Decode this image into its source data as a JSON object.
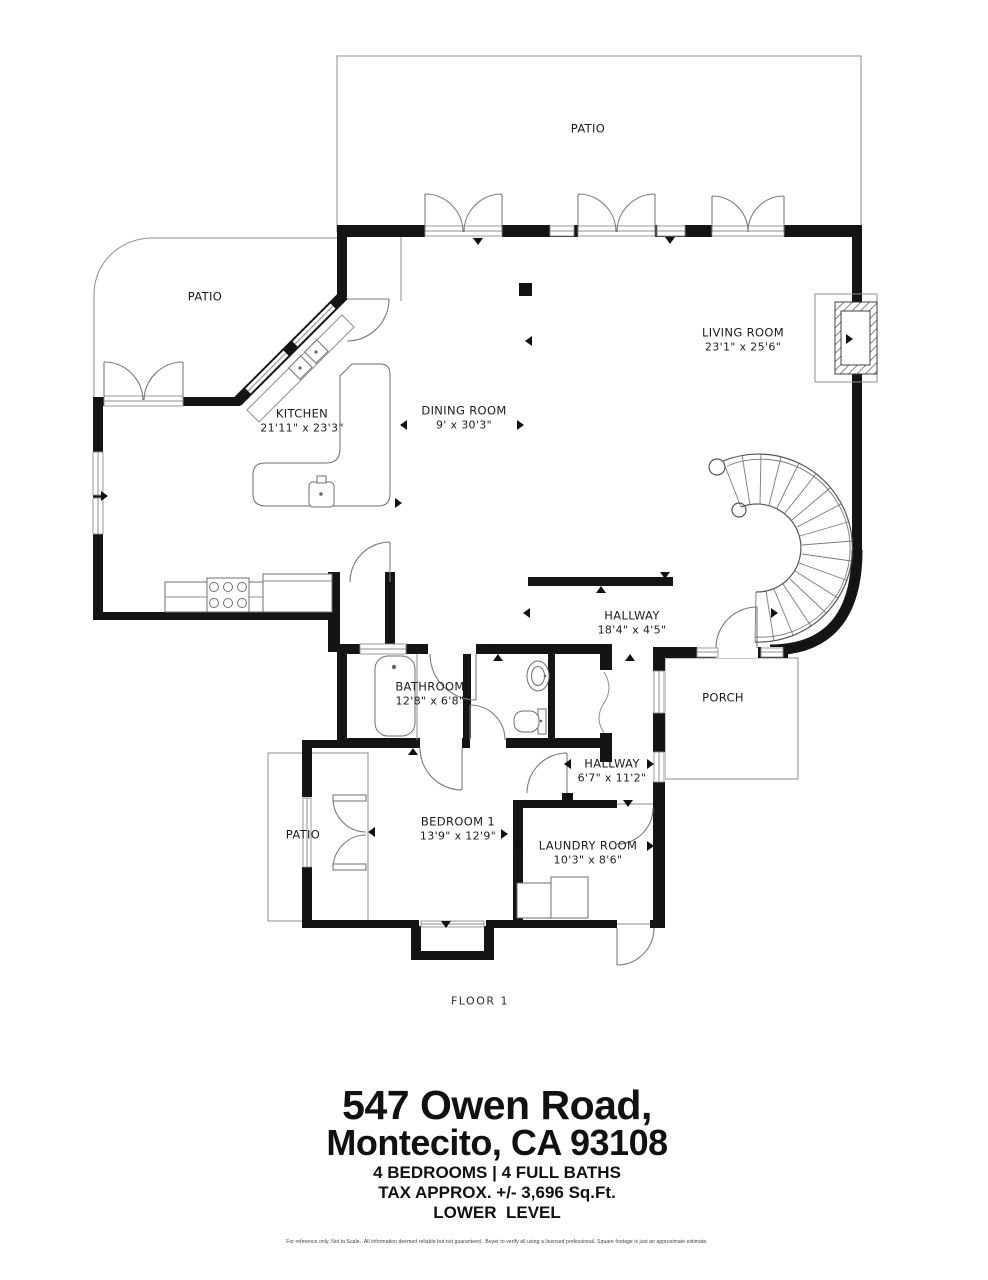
{
  "colors": {
    "walls": "#141414",
    "thin_lines": "#8e8e8e",
    "label_text": "#1c1c1c",
    "background": "#ffffff"
  },
  "plan": {
    "floor_label": "FLOOR 1",
    "areas": [
      {
        "id": "patio-top",
        "name": "PATIO"
      },
      {
        "id": "patio-left",
        "name": "PATIO"
      },
      {
        "id": "porch",
        "name": "PORCH"
      },
      {
        "id": "patio-bottom",
        "name": "PATIO"
      }
    ],
    "rooms": [
      {
        "id": "living-room",
        "name": "LIVING ROOM",
        "dims": "23'1\" x 25'6\""
      },
      {
        "id": "kitchen",
        "name": "KITCHEN",
        "dims": "21'11\" x 23'3\""
      },
      {
        "id": "dining-room",
        "name": "DINING ROOM",
        "dims": "9' x 30'3\""
      },
      {
        "id": "hallway-main",
        "name": "HALLWAY",
        "dims": "18'4\" x 4'5\""
      },
      {
        "id": "bathroom",
        "name": "BATHROOM",
        "dims": "12'8\" x 6'8\""
      },
      {
        "id": "hallway-lower",
        "name": "HALLWAY",
        "dims": "6'7\" x 11'2\""
      },
      {
        "id": "bedroom-1",
        "name": "BEDROOM 1",
        "dims": "13'9\" x 12'9\""
      },
      {
        "id": "laundry-room",
        "name": "LAUNDRY ROOM",
        "dims": "10'3\" x 8'6\""
      }
    ]
  },
  "title_block": {
    "address_line1": "547 Owen Road,",
    "address_line2": "Montecito, CA 93108",
    "beds_baths": "4 BEDROOMS | 4 FULL BATHS",
    "tax_area": "TAX APPROX. +/- 3,696 Sq.Ft.",
    "level": "LOWER  LEVEL",
    "disclaimer": "For reference only. Not to Scale.  All information deemed reliable but not guaranteed.  Buyer to verify all using a licensed professional. Square footage is just an approximate estimate."
  }
}
